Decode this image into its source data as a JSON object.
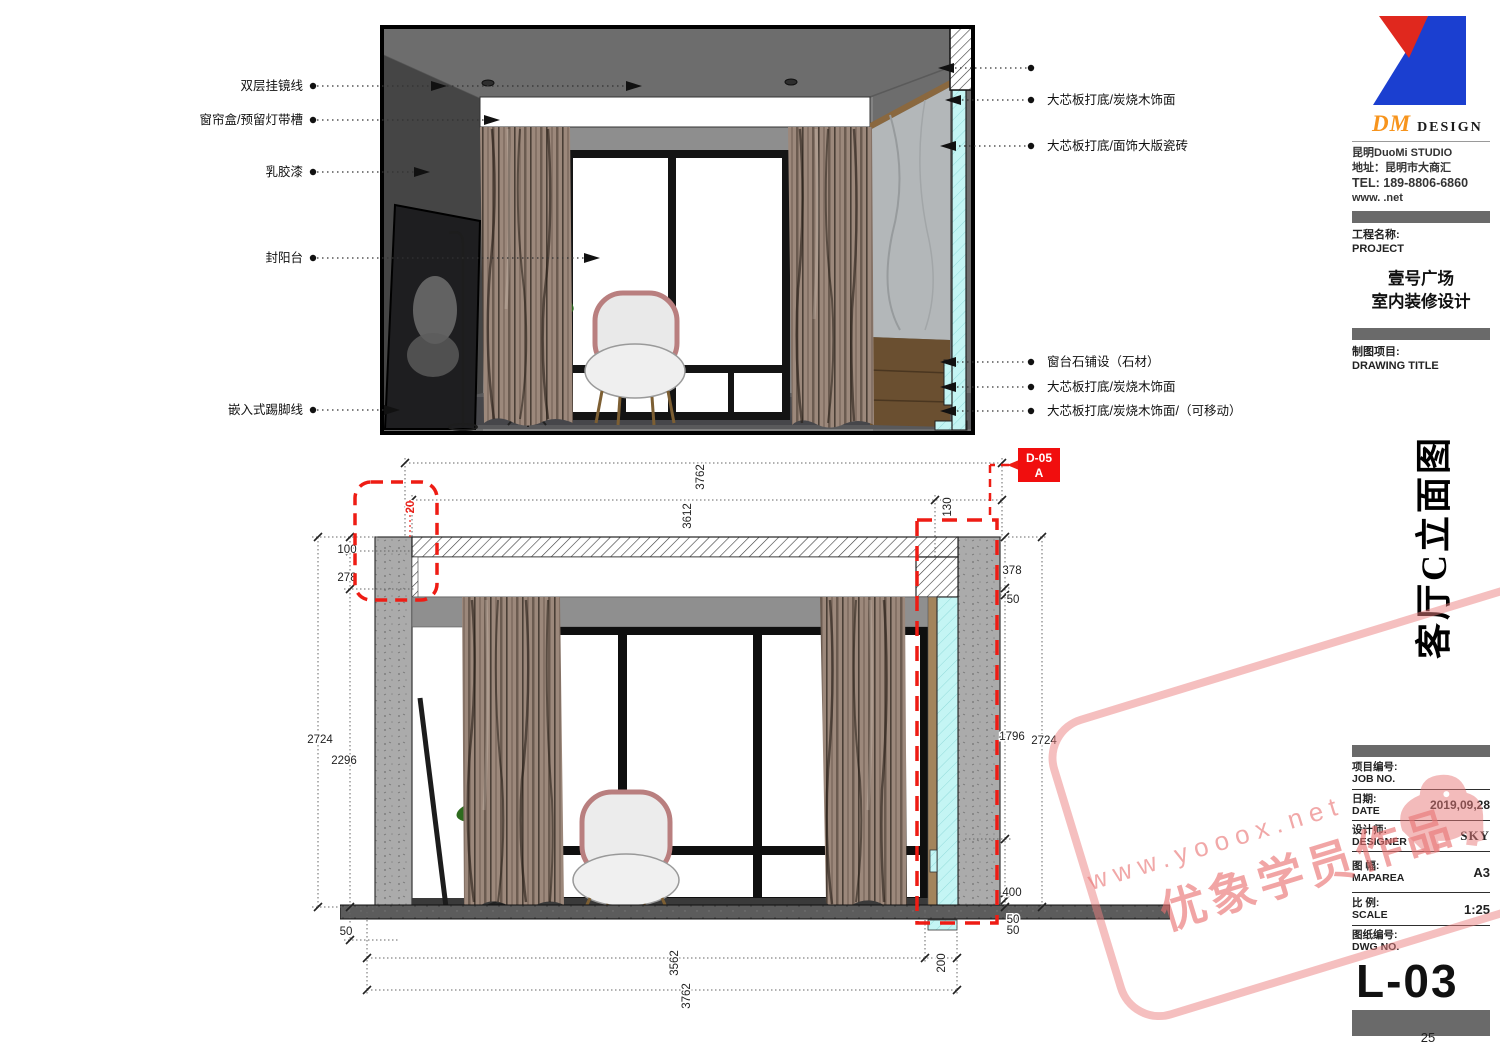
{
  "annotations": {
    "left": [
      "双层挂镜线",
      "窗帘盒/预留灯带槽",
      "乳胶漆",
      "封阳台",
      "嵌入式踢脚线"
    ],
    "right": [
      "大芯板打底/炭烧木饰面",
      "大芯板打底/面饰大版瓷砖",
      "窗台石铺设（石材）",
      "大芯板打底/炭烧木饰面",
      "大芯板打底/炭烧木饰面/（可移动）"
    ]
  },
  "detail_callout": {
    "code": "D-05",
    "zone": "A"
  },
  "dim": {
    "top_overall": "3762",
    "top_inner": "3612",
    "top_130": "130",
    "top_20": "20",
    "l_100": "100",
    "l_278": "278",
    "l_2724": "2724",
    "l_2296": "2296",
    "l_50": "50",
    "r_378": "378",
    "r_50a": "50",
    "r_1796": "1796",
    "r_2724": "2724",
    "r_400": "400",
    "r_50b": "50",
    "r_50c": "50",
    "b_3562": "3562",
    "b_3762": "3762",
    "b_200": "200"
  },
  "title_block": {
    "logo_dm": "DM",
    "logo_design": "DESIGN",
    "studio": "昆明DuoMi STUDIO",
    "address": "地址：昆明市大商汇",
    "tel": "TEL: 189-8806-6860",
    "web": "www. .net",
    "project_label_cn": "工程名称:",
    "project_label_en": "PROJECT",
    "project_name_line1": "壹号广场",
    "project_name_line2": "室内装修设计",
    "drawing_label_cn": "制图项目:",
    "drawing_label_en": "DRAWING TITLE",
    "drawing_title": "客厅C立面图",
    "job_label_cn": "项目编号:",
    "job_label_en": "JOB NO.",
    "date_label_cn": "日期:",
    "date_label_en": "DATE",
    "date_value": "2019,09,28",
    "designer_label_cn": "设计师:",
    "designer_label_en": "DESIGNER",
    "designer_value": "SKY",
    "maparea_label_cn": "图 幅:",
    "maparea_label_en": "MAPAREA",
    "maparea_value": "A3",
    "scale_label_cn": "比 例:",
    "scale_label_en": "SCALE",
    "scale_value": "1:25",
    "dwg_label_cn": "图纸编号:",
    "dwg_label_en": "DWG NO.",
    "dwg_value": "L-03"
  },
  "watermark": {
    "url": "www.yooox.net",
    "text": "优象学员作品"
  },
  "page_number": "25",
  "colors": {
    "accent_red": "#ee1c14",
    "highlight_cyan": "#c4f5f4",
    "watermark_pink": "#e87a7a",
    "logo_orange": "#f7941d",
    "logo_blue": "#1b3fd0",
    "logo_red": "#e0281e"
  }
}
